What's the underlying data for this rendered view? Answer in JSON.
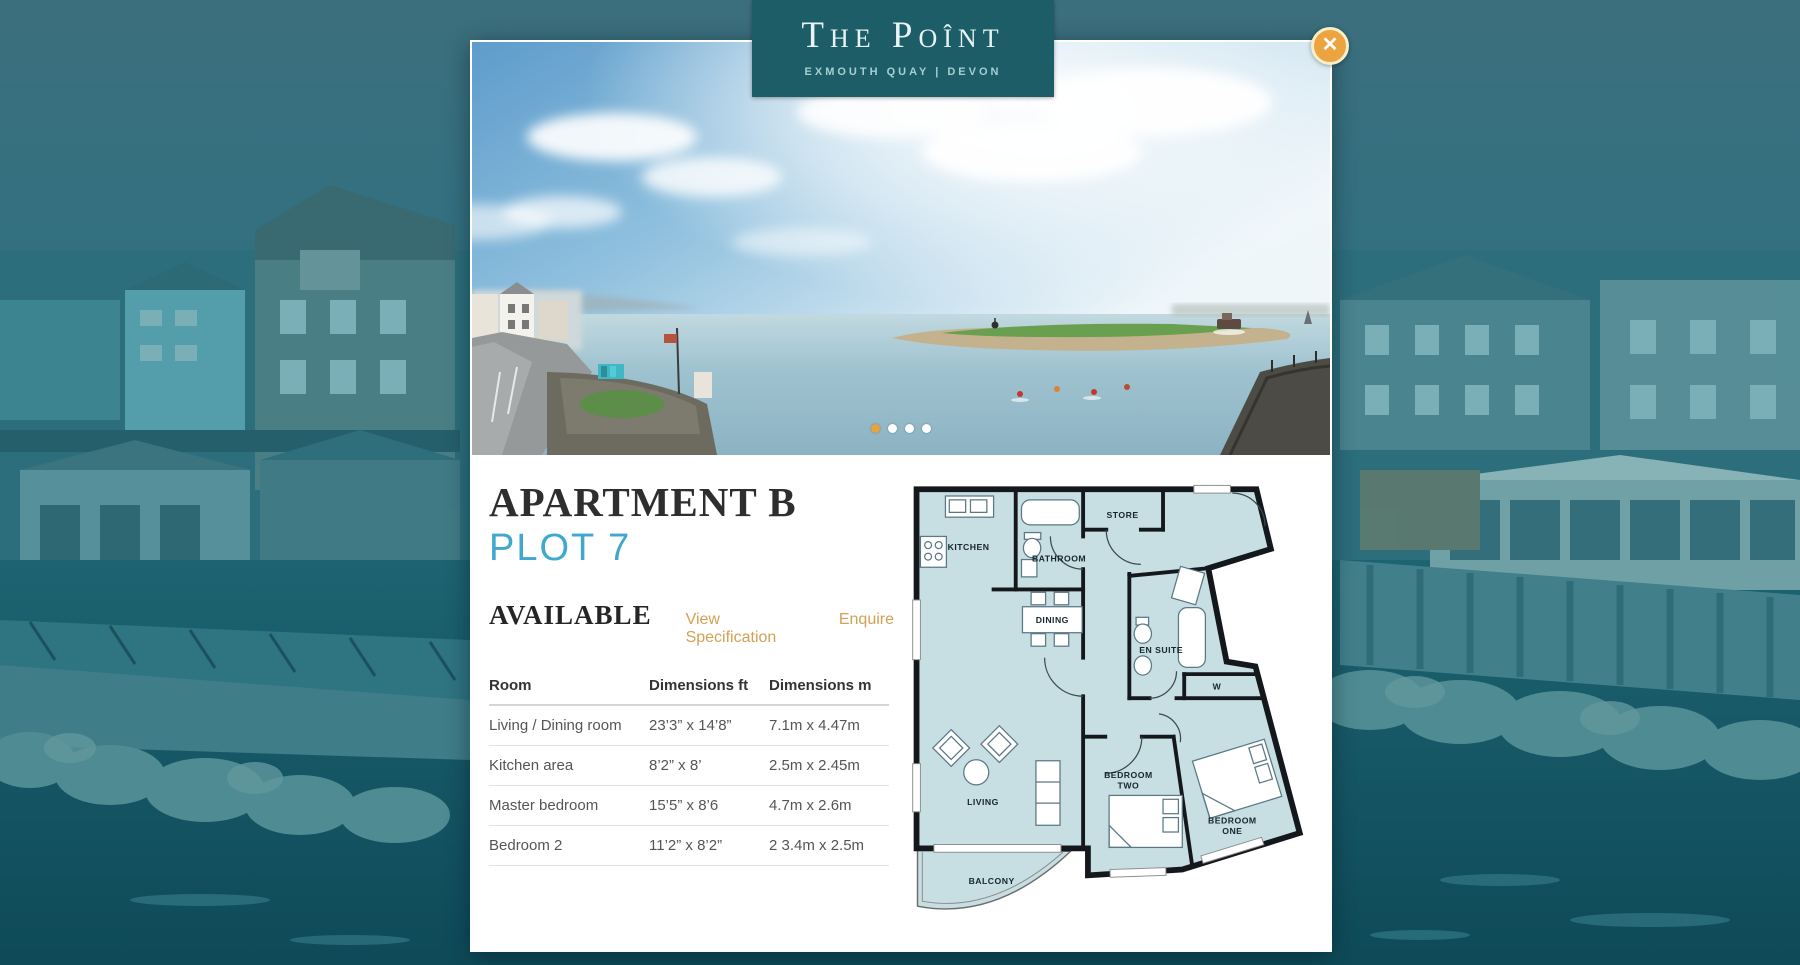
{
  "brand": {
    "title": "The Poînt",
    "subtitle": "EXMOUTH QUAY | DEVON"
  },
  "close": {
    "glyph": "✕"
  },
  "carousel": {
    "slide_count": 4,
    "active_index": 0
  },
  "apartment": {
    "title": "APARTMENT B",
    "plot": "PLOT 7",
    "status": "AVAILABLE",
    "spec_link": "View Specification",
    "enquire_link": "Enquire"
  },
  "table": {
    "columns": [
      "Room",
      "Dimensions ft",
      "Dimensions m"
    ],
    "rows": [
      [
        "Living / Dining room",
        "23’3” x 14’8”",
        "7.1m x 4.47m"
      ],
      [
        "Kitchen area",
        "8’2” x 8’",
        "2.5m x 2.45m"
      ],
      [
        "Master bedroom",
        "15’5” x 8’6",
        "4.7m x 2.6m"
      ],
      [
        "Bedroom 2",
        "11’2” x 8’2”",
        "2 3.4m x 2.5m"
      ]
    ]
  },
  "floorplan": {
    "labels": {
      "kitchen": "KITCHEN",
      "bathroom": "BATHROOM",
      "store": "STORE",
      "dining": "DINING",
      "ensuite": "EN SUITE",
      "wardrobe": "W",
      "living": "LIVING",
      "bedroom_two_1": "BEDROOM",
      "bedroom_two_2": "TWO",
      "bedroom_one_1": "BEDROOM",
      "bedroom_one_2": "ONE",
      "balcony": "BALCONY"
    }
  },
  "colors": {
    "banner_teal": "#1c5d68",
    "page_teal": "#23687a",
    "plot_blue": "#3fa8ce",
    "link_gold": "#d2a153",
    "close_orange": "#eba440",
    "dot_active": "#e8a33d",
    "floor_fill": "#c7dee2",
    "wall": "#14181c"
  }
}
